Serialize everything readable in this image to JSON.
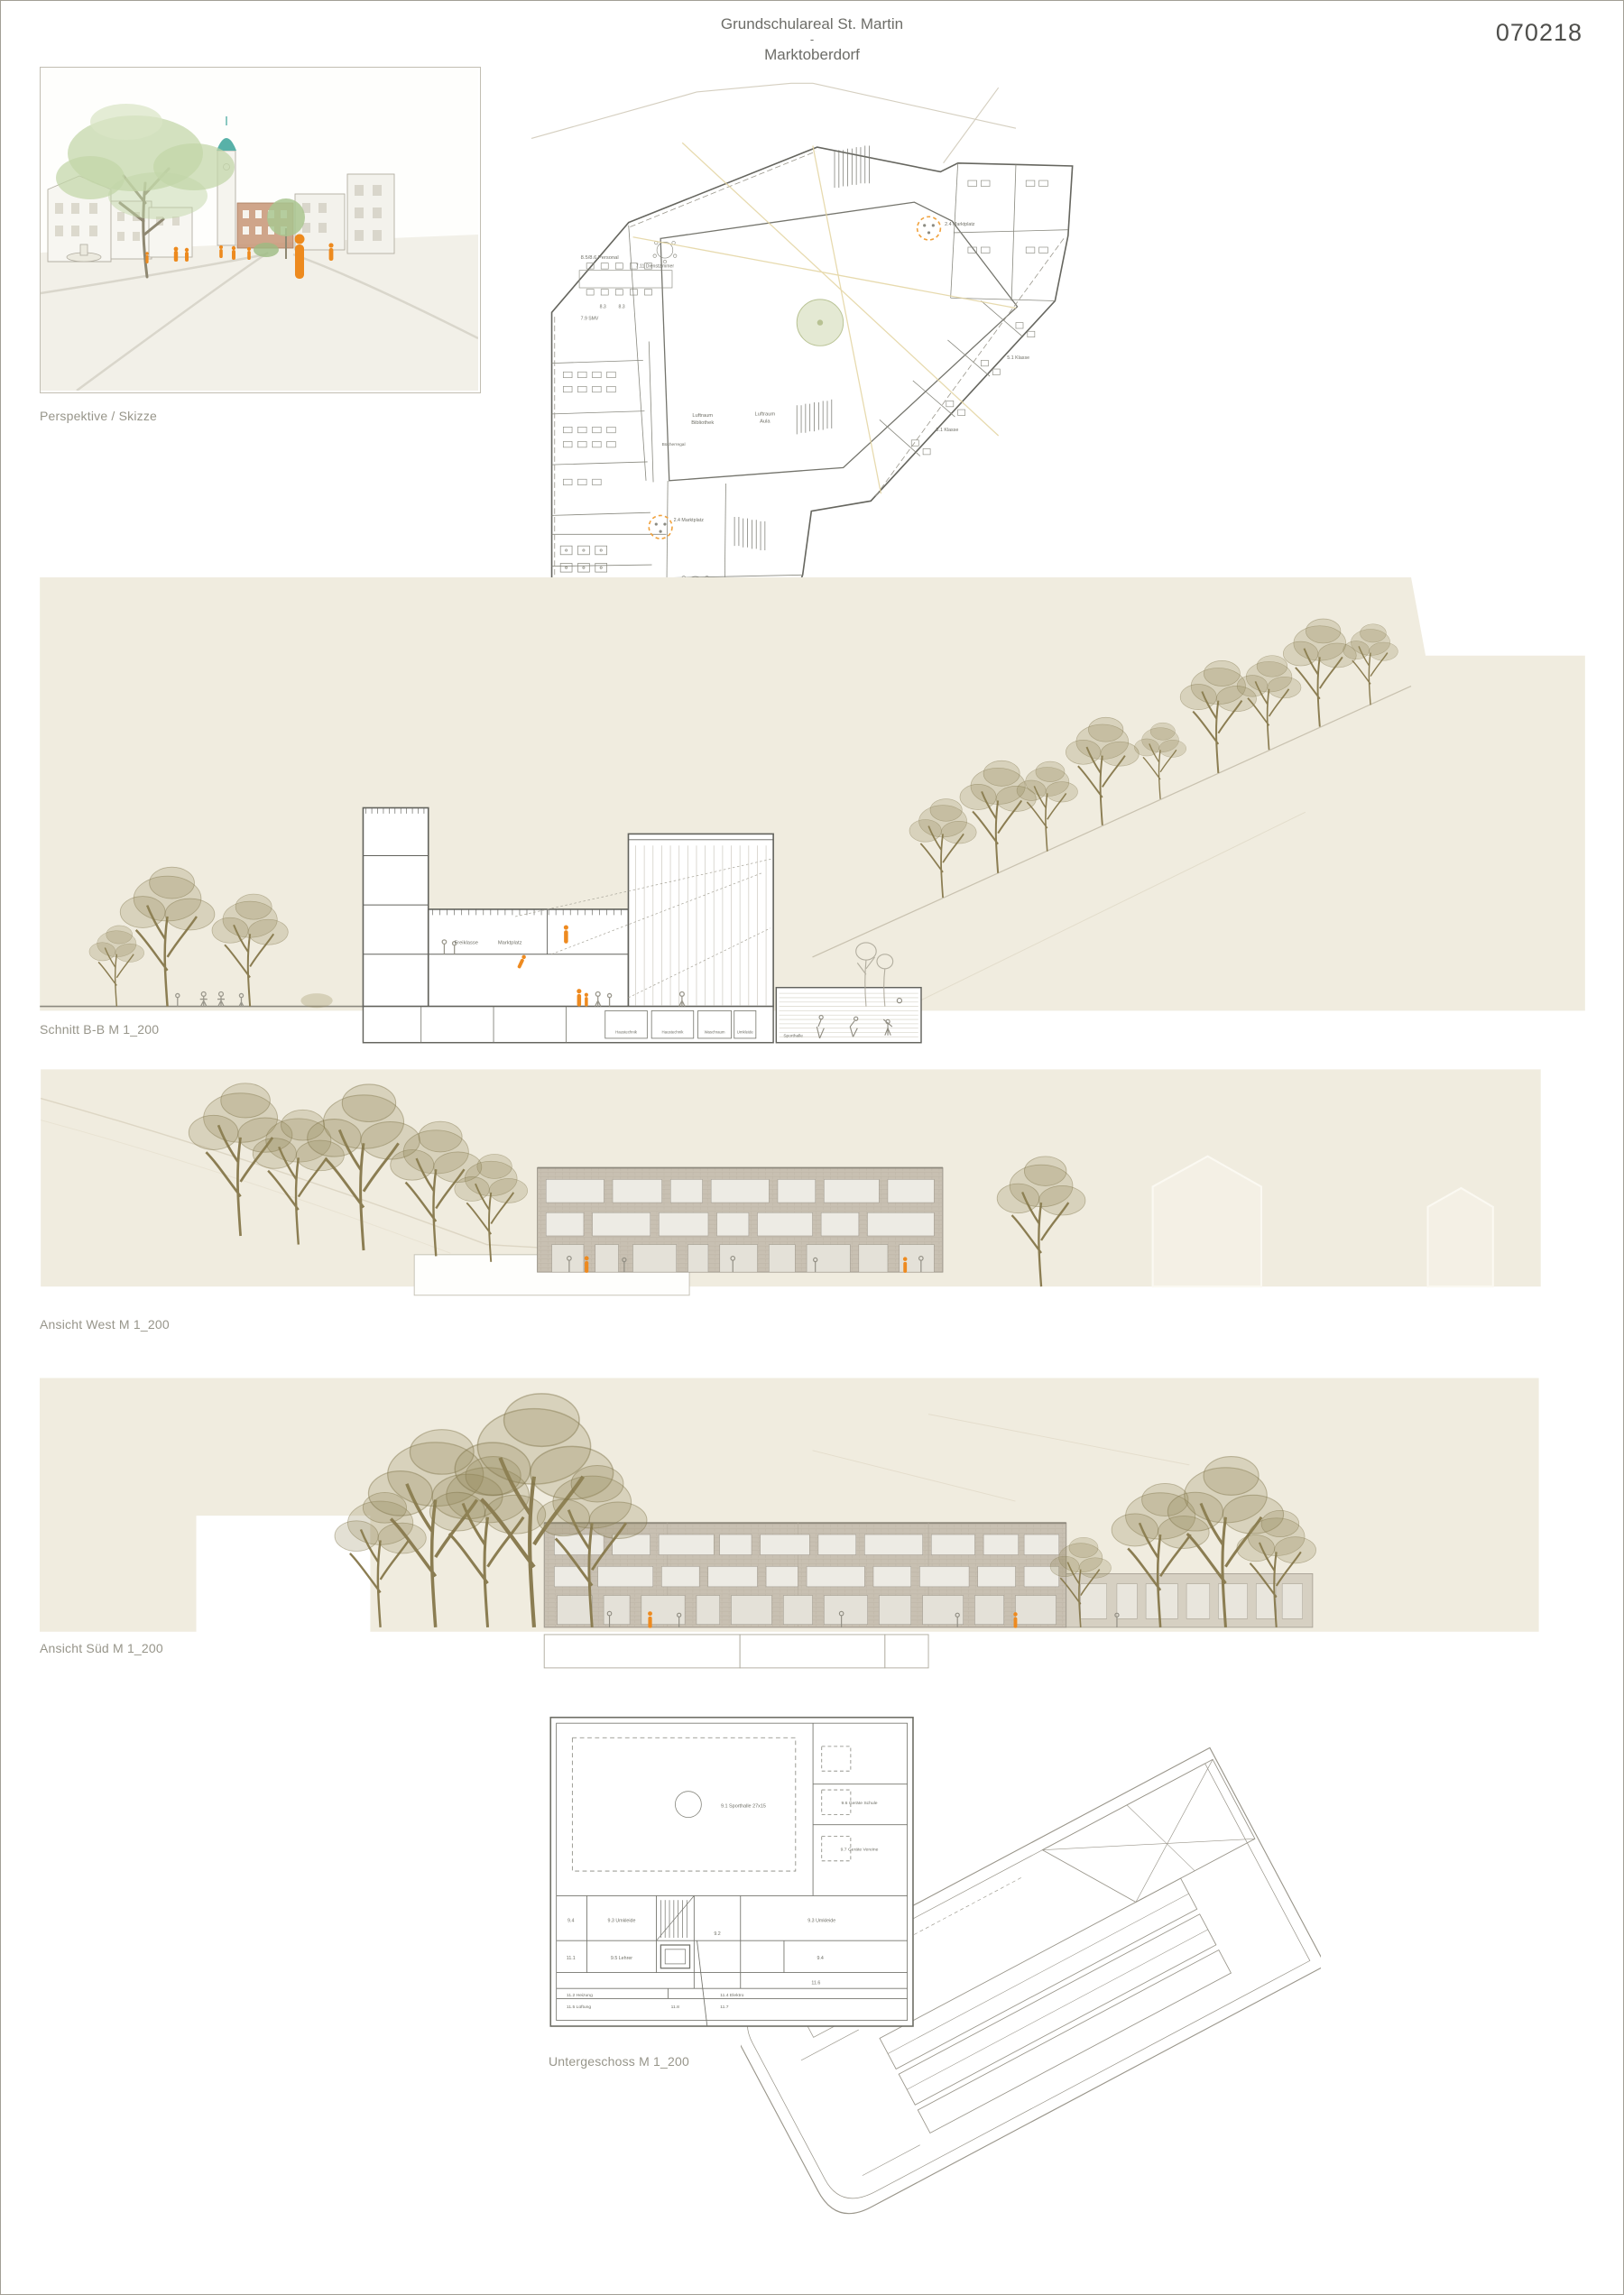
{
  "sheet": {
    "title": "Grundschulareal St. Martin",
    "separator": "-",
    "subtitle": "Marktoberdorf",
    "code": "070218"
  },
  "captions": {
    "perspective": "Perspektive / Skizze",
    "og2": "2. Obergeschoss M 1_200",
    "schnitt": "Schnitt B-B M 1_200",
    "west": "Ansicht West M 1_200",
    "sued": "Ansicht Süd M 1_200",
    "ug": "Untergeschoss M 1_200"
  },
  "og2_labels": {
    "personal": "8.5/8.6 Personal",
    "dienstzimmer": "7.11 Dienstzimmer",
    "r83a": "8.3",
    "r83b": "8.3",
    "smv": "7.9 SMV",
    "luftraum_bib1": "Luftraum",
    "luftraum_bib2": "Bibliothek",
    "luftraum_aula1": "Luftraum",
    "luftraum_aula2": "Aula",
    "buecherregal": "Bücherregal",
    "marktplatz_a": "2.4 Marktplatz",
    "marktplatz_b": "2.4 Marktplatz",
    "klasse_a": "5.1 Klasse",
    "klasse_b": "5.1 Klasse"
  },
  "schnitt_labels": {
    "freiklasse": "Freiklasse",
    "marktplatz": "Marktplatz",
    "keller1": "Haustechnik",
    "keller2": "Haustechnik",
    "keller3": "Waschraum",
    "keller4": "Umkleide",
    "sporthalle": "Sporthalle"
  },
  "ug_labels": {
    "sporthalle": "9.1 Sporthalle 27x15",
    "geraete_schule": "9.6 Geräte Schule",
    "geraete_vereine": "9.7 Geräte Vereine",
    "r94a": "9.4",
    "umkleide_a": "9.3 Umkleide",
    "umkleide_b": "9.3 Umkleide",
    "r92": "9.2",
    "r94b": "9.4",
    "r111": "11.1",
    "lehrer": "9.5 Lehrer",
    "r116": "11.6",
    "heizung": "11.2 Heizung",
    "lueftung": "11.5 Lüftung",
    "r118": "11.8",
    "elektro": "11.4 Elektro",
    "r117": "11.7"
  },
  "colors": {
    "beige_band": "#f0ecdf",
    "accent_orange": "#ee8a1f",
    "tree_olive": "#8d8055",
    "facade_brick": "#c8c0b2",
    "spire_teal": "#55b0a8",
    "line_gray": "#6e6e66"
  }
}
